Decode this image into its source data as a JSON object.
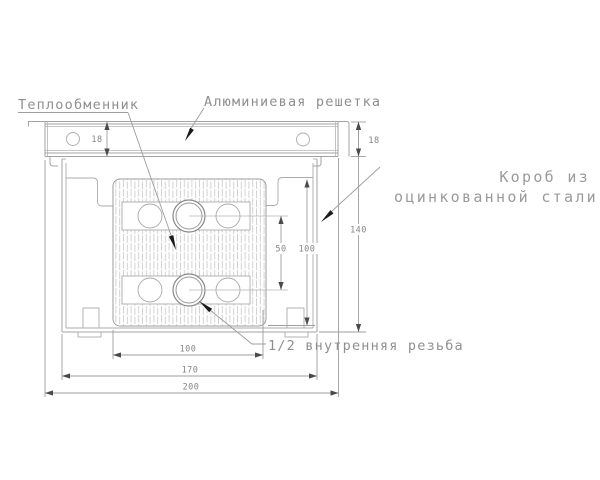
{
  "drawing": {
    "labels": {
      "heat_exchanger": "Теплообменник",
      "aluminum_grille": "Алюминиевая решетка",
      "box_line1": "Короб из",
      "box_line2": "оцинкованной стали",
      "thread": "1/2 внутренняя резьба"
    },
    "dims": {
      "grille_height_left": "18",
      "grille_height_right": "18",
      "overall_height": "140",
      "core_height": "100",
      "pipe_spacing": "50",
      "core_width": "100",
      "box_width": "170",
      "overall_width": "200"
    },
    "colors": {
      "background": "#ffffff",
      "line": "#a3a3a3",
      "hatch": "#c8c8c8",
      "text": "#8f8f8f",
      "leader_arrow": "#1a1a1a"
    }
  }
}
